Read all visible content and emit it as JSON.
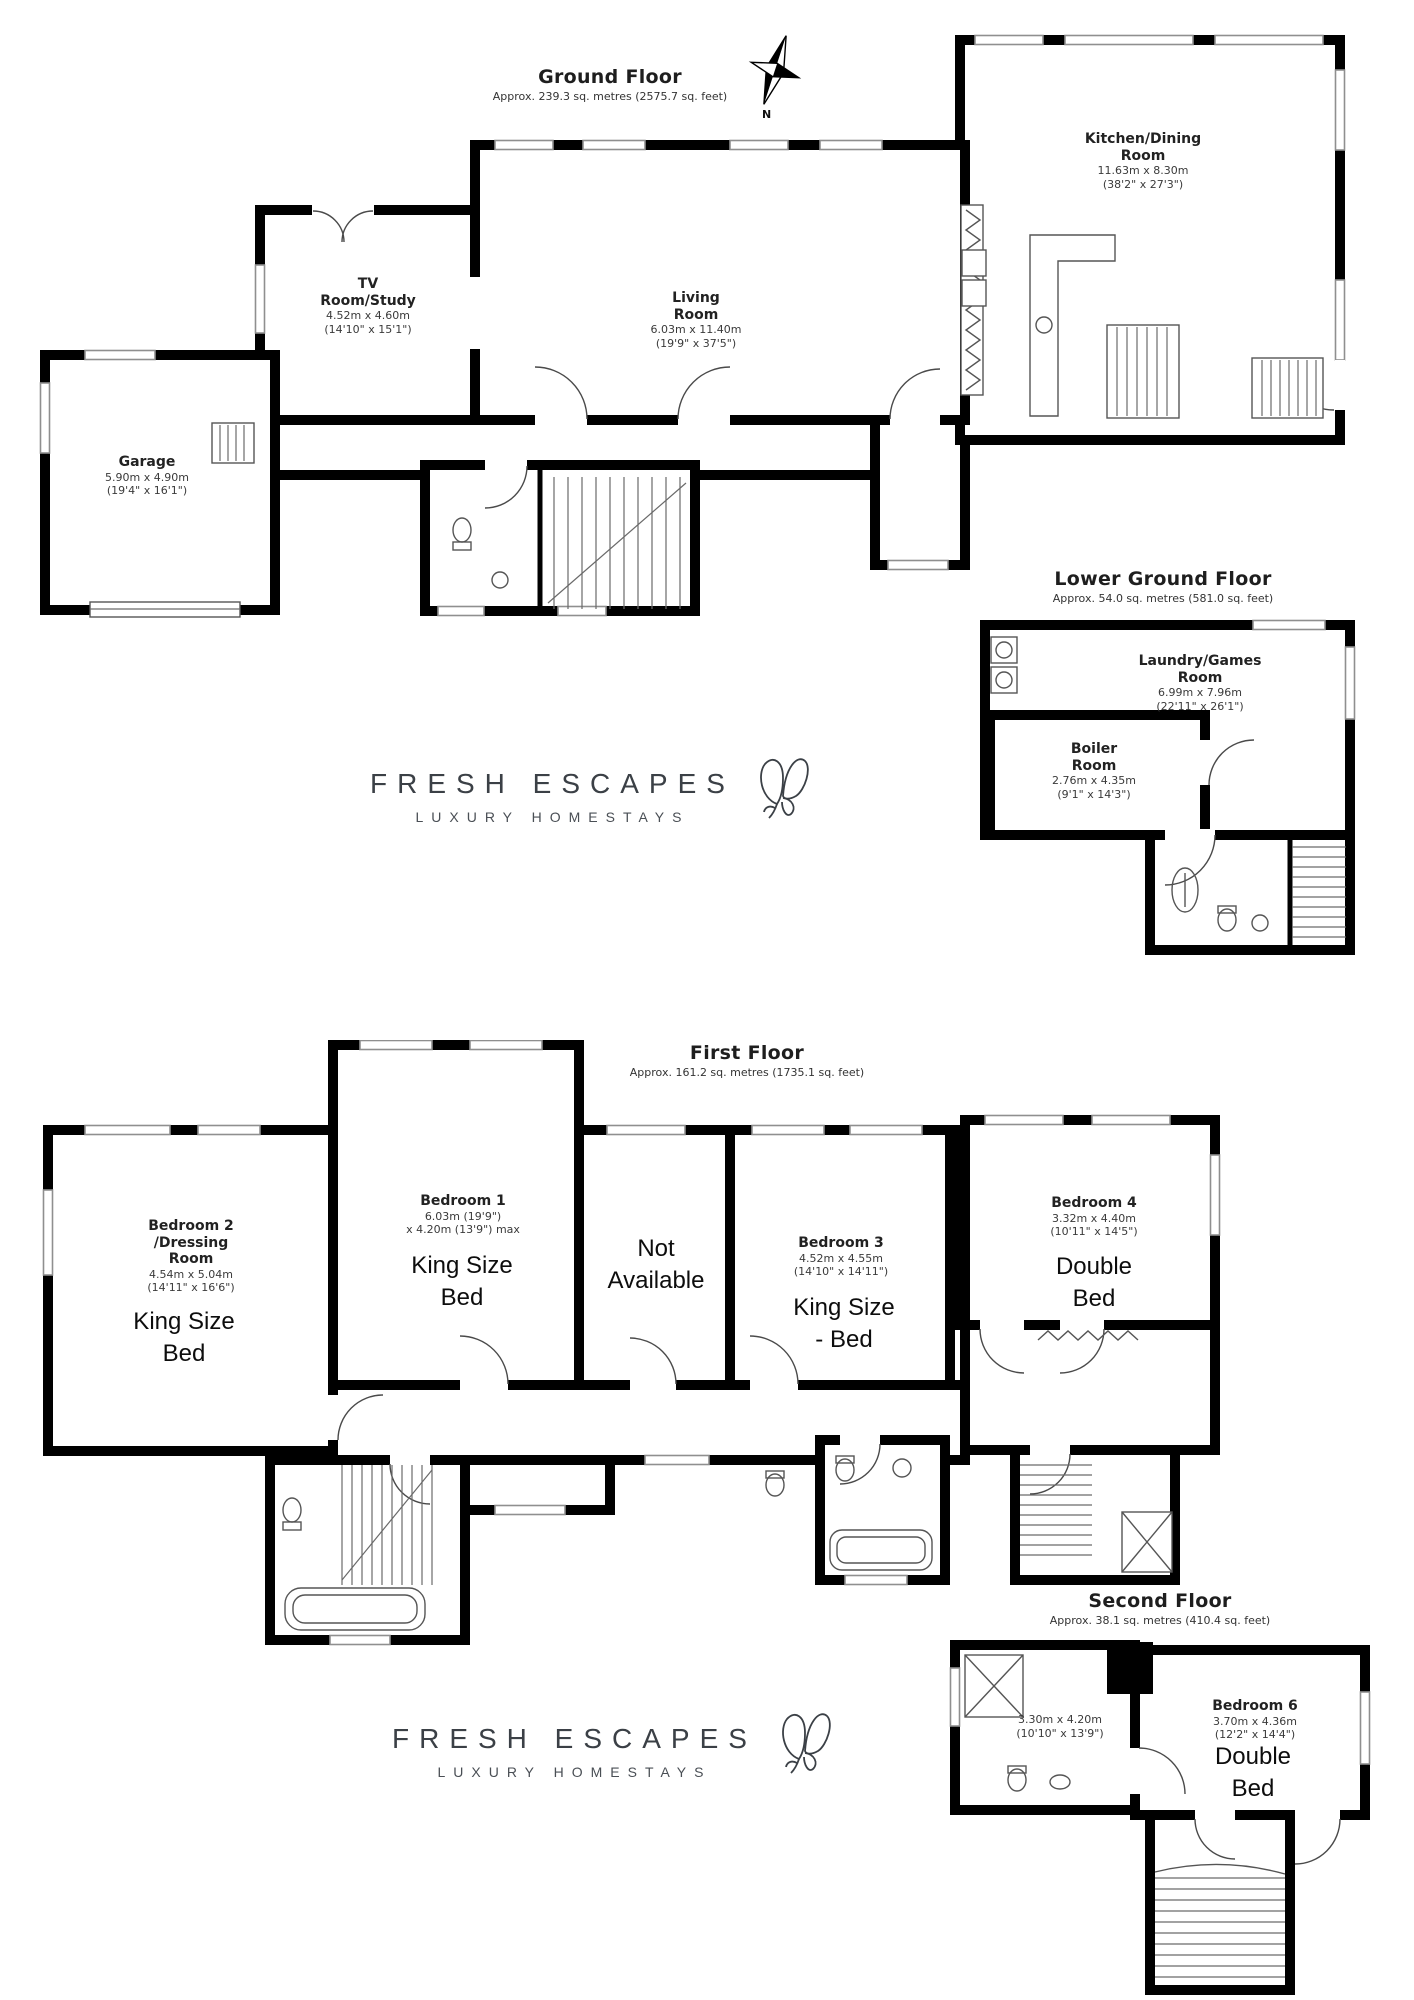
{
  "brand": {
    "name": "FRESH ESCAPES",
    "tagline": "LUXURY HOMESTAYS"
  },
  "compass": {
    "north_label": "N"
  },
  "floors": {
    "ground": {
      "title": "Ground Floor",
      "area": "Approx. 239.3 sq. metres (2575.7 sq. feet)",
      "rooms": {
        "kitchen_dining": {
          "name_line1": "Kitchen/Dining",
          "name_line2": "Room",
          "dims_m": "11.63m x 8.30m",
          "dims_ft": "(38'2\" x 27'3\")"
        },
        "living": {
          "name_line1": "Living",
          "name_line2": "Room",
          "dims_m": "6.03m x 11.40m",
          "dims_ft": "(19'9\" x 37'5\")"
        },
        "tv_study": {
          "name_line1": "TV",
          "name_line2": "Room/Study",
          "dims_m": "4.52m x 4.60m",
          "dims_ft": "(14'10\" x 15'1\")"
        },
        "garage": {
          "name_line1": "Garage",
          "dims_m": "5.90m x 4.90m",
          "dims_ft": "(19'4\" x 16'1\")"
        }
      }
    },
    "lower_ground": {
      "title": "Lower Ground Floor",
      "area": "Approx. 54.0 sq. metres (581.0 sq. feet)",
      "rooms": {
        "laundry_games": {
          "name_line1": "Laundry/Games",
          "name_line2": "Room",
          "dims_m": "6.99m x 7.96m",
          "dims_ft": "(22'11\" x 26'1\")"
        },
        "boiler": {
          "name_line1": "Boiler",
          "name_line2": "Room",
          "dims_m": "2.76m x 4.35m",
          "dims_ft": "(9'1\" x 14'3\")"
        }
      }
    },
    "first": {
      "title": "First Floor",
      "area": "Approx. 161.2 sq. metres (1735.1 sq. feet)",
      "rooms": {
        "bedroom2": {
          "name_line1": "Bedroom 2",
          "name_line2": "/Dressing",
          "name_line3": "Room",
          "dims_m": "4.54m x 5.04m",
          "dims_ft": "(14'11\" x 16'6\")",
          "note_line1": "King Size",
          "note_line2": "Bed"
        },
        "bedroom1": {
          "name_line1": "Bedroom 1",
          "dims_m": "6.03m (19'9\")",
          "dims_ft": "x 4.20m (13'9\") max",
          "note_line1": "King Size",
          "note_line2": "Bed"
        },
        "not_available": {
          "note_line1": "Not",
          "note_line2": "Available"
        },
        "bedroom3": {
          "name_line1": "Bedroom 3",
          "dims_m": "4.52m x 4.55m",
          "dims_ft": "(14'10\" x 14'11\")",
          "note_line1": "King Size",
          "note_line2": "- Bed"
        },
        "bedroom4": {
          "name_line1": "Bedroom 4",
          "dims_m": "3.32m x 4.40m",
          "dims_ft": "(10'11\" x 14'5\")",
          "note_line1": "Double",
          "note_line2": "Bed"
        }
      }
    },
    "second": {
      "title": "Second Floor",
      "area": "Approx. 38.1 sq. metres (410.4 sq. feet)",
      "rooms": {
        "landing_room": {
          "dims_m": "3.30m x 4.20m",
          "dims_ft": "(10'10\" x 13'9\")"
        },
        "bedroom6": {
          "name_line1": "Bedroom 6",
          "dims_m": "3.70m x 4.36m",
          "dims_ft": "(12'2\" x 14'4\")",
          "note_line1": "Double",
          "note_line2": "Bed"
        }
      }
    }
  },
  "colors": {
    "wall": "#000000",
    "window_frame": "#8f8f8f",
    "text": "#2a2a2a",
    "logo_text": "#3b4046"
  }
}
